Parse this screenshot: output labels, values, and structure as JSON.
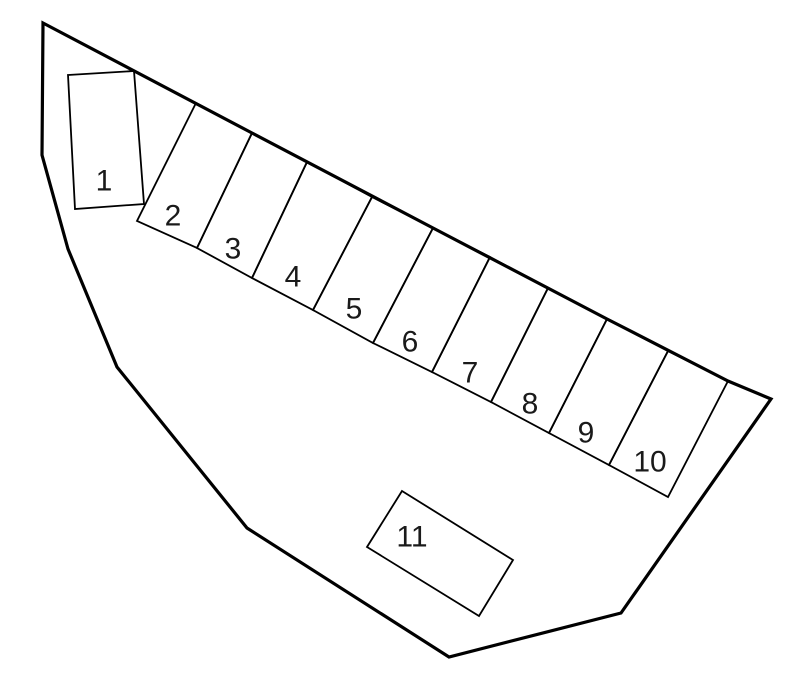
{
  "diagram": {
    "type": "site-plan",
    "description": "Irregular land parcel outline containing eleven numbered parking/lot spaces; spaces 2-10 form a slanted row along the upper boundary, space 1 is a rotated rectangle at upper left, space 11 is a rotated rectangle near the bottom center.",
    "background_color": "#ffffff",
    "line_color": "#000000",
    "label_color": "#1a1a1a",
    "label_font_size": 30,
    "space_stroke_width": 1.8,
    "boundary": {
      "stroke_width": 3.2,
      "points": [
        [
          43,
          23
        ],
        [
          252,
          133
        ],
        [
          433,
          228
        ],
        [
          607,
          319
        ],
        [
          728,
          381
        ],
        [
          771,
          399
        ],
        [
          621,
          613
        ],
        [
          449,
          657
        ],
        [
          247,
          528
        ],
        [
          117,
          367
        ],
        [
          68,
          249
        ],
        [
          42,
          155
        ]
      ]
    },
    "spaces": [
      {
        "label": "1",
        "points": [
          [
            68,
            75
          ],
          [
            134,
            71
          ],
          [
            144,
            204
          ],
          [
            75,
            209
          ]
        ],
        "label_xy": [
          104,
          181
        ]
      },
      {
        "label": "2",
        "points": [
          [
            196,
            103
          ],
          [
            252,
            133
          ],
          [
            197,
            248
          ],
          [
            137,
            221
          ]
        ],
        "label_xy": [
          173,
          216
        ]
      },
      {
        "label": "3",
        "points": [
          [
            252,
            133
          ],
          [
            307,
            162
          ],
          [
            252,
            278
          ],
          [
            197,
            248
          ]
        ],
        "label_xy": [
          233,
          249
        ]
      },
      {
        "label": "4",
        "points": [
          [
            307,
            162
          ],
          [
            372,
            197
          ],
          [
            313,
            310
          ],
          [
            252,
            278
          ]
        ],
        "label_xy": [
          293,
          277
        ]
      },
      {
        "label": "5",
        "points": [
          [
            372,
            197
          ],
          [
            433,
            228
          ],
          [
            373,
            343
          ],
          [
            313,
            310
          ]
        ],
        "label_xy": [
          354,
          309
        ]
      },
      {
        "label": "6",
        "points": [
          [
            433,
            228
          ],
          [
            490,
            257
          ],
          [
            432,
            372
          ],
          [
            373,
            343
          ]
        ],
        "label_xy": [
          410,
          342
        ]
      },
      {
        "label": "7",
        "points": [
          [
            490,
            257
          ],
          [
            548,
            288
          ],
          [
            491,
            402
          ],
          [
            432,
            372
          ]
        ],
        "label_xy": [
          470,
          373
        ]
      },
      {
        "label": "8",
        "points": [
          [
            548,
            288
          ],
          [
            607,
            319
          ],
          [
            549,
            433
          ],
          [
            491,
            402
          ]
        ],
        "label_xy": [
          530,
          404
        ]
      },
      {
        "label": "9",
        "points": [
          [
            607,
            319
          ],
          [
            668,
            351
          ],
          [
            609,
            465
          ],
          [
            549,
            433
          ]
        ],
        "label_xy": [
          586,
          433
        ]
      },
      {
        "label": "10",
        "points": [
          [
            668,
            351
          ],
          [
            728,
            381
          ],
          [
            668,
            497
          ],
          [
            609,
            465
          ]
        ],
        "label_xy": [
          650,
          462
        ]
      },
      {
        "label": "11",
        "points": [
          [
            402,
            491
          ],
          [
            513,
            560
          ],
          [
            479,
            616
          ],
          [
            367,
            547
          ]
        ],
        "label_xy": [
          412,
          537
        ]
      }
    ]
  }
}
